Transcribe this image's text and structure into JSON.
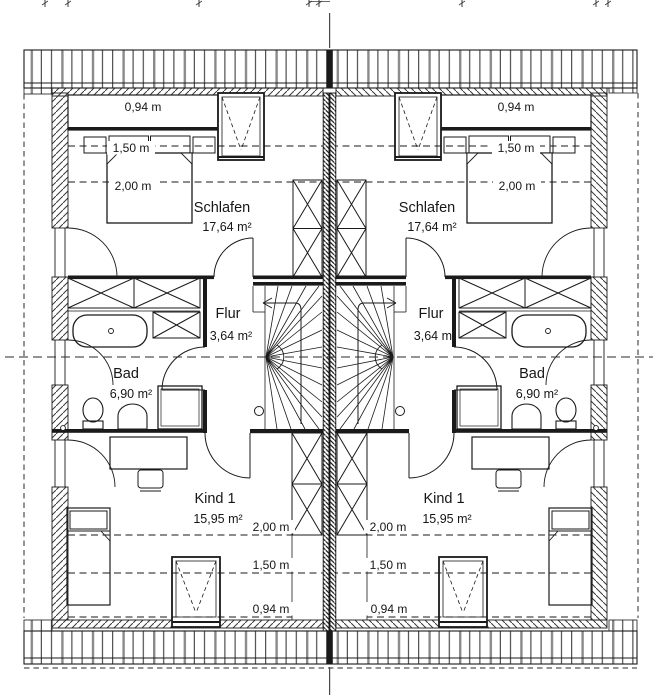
{
  "plan_type": "attic floor plan, mirrored semi-detached house",
  "units": [
    {
      "side": "left",
      "rooms": [
        {
          "name": "Schlafen",
          "area": "17,64 m²"
        },
        {
          "name": "Flur",
          "area": "3,64 m²"
        },
        {
          "name": "Bad",
          "area": "6,90 m²"
        },
        {
          "name": "Kind 1",
          "area": "15,95 m²"
        }
      ],
      "height_labels_top": [
        "0,94 m",
        "1,50 m",
        "2,00 m"
      ],
      "height_labels_bottom": [
        "2,00 m",
        "1,50 m",
        "0,94 m"
      ]
    },
    {
      "side": "right",
      "rooms": [
        {
          "name": "Schlafen",
          "area": "17,64 m²"
        },
        {
          "name": "Flur",
          "area": "3,64 m²"
        },
        {
          "name": "Bad",
          "area": "6,90 m²"
        },
        {
          "name": "Kind 1",
          "area": "15,95 m²"
        }
      ],
      "height_labels_top": [
        "0,94 m",
        "1,50 m",
        "2,00 m"
      ],
      "height_labels_bottom": [
        "2,00 m",
        "1,50 m",
        "0,94 m"
      ]
    }
  ]
}
